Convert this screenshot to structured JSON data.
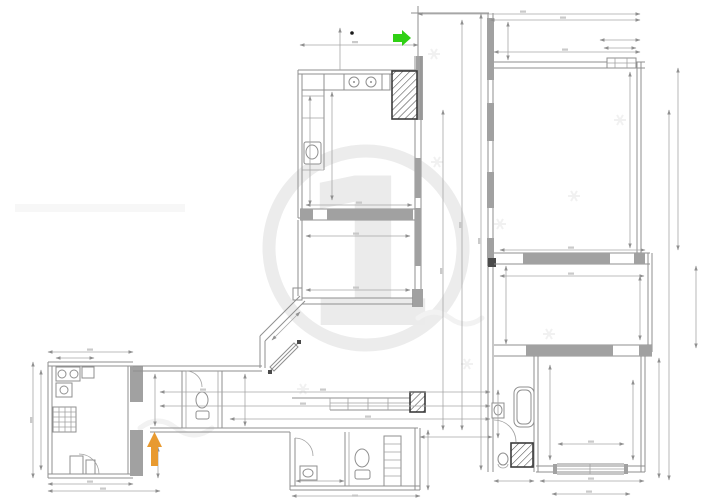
{
  "canvas": {
    "background": "#ffffff"
  },
  "colors": {
    "line": "#8f8f8f",
    "dim_line": "#a6a6a6",
    "wall_fill": "#a1a1a1",
    "hatch_stroke": "#3c3c3c",
    "watermark": "#ececec",
    "arrow_green": "#2fd014",
    "arrow_orange": "#e89a30",
    "dot": "#1a1a1a"
  },
  "watermark": {
    "glyph": "1"
  },
  "markers": {
    "green_arrow": {
      "direction": "right"
    },
    "orange_arrow": {
      "direction": "up"
    }
  }
}
